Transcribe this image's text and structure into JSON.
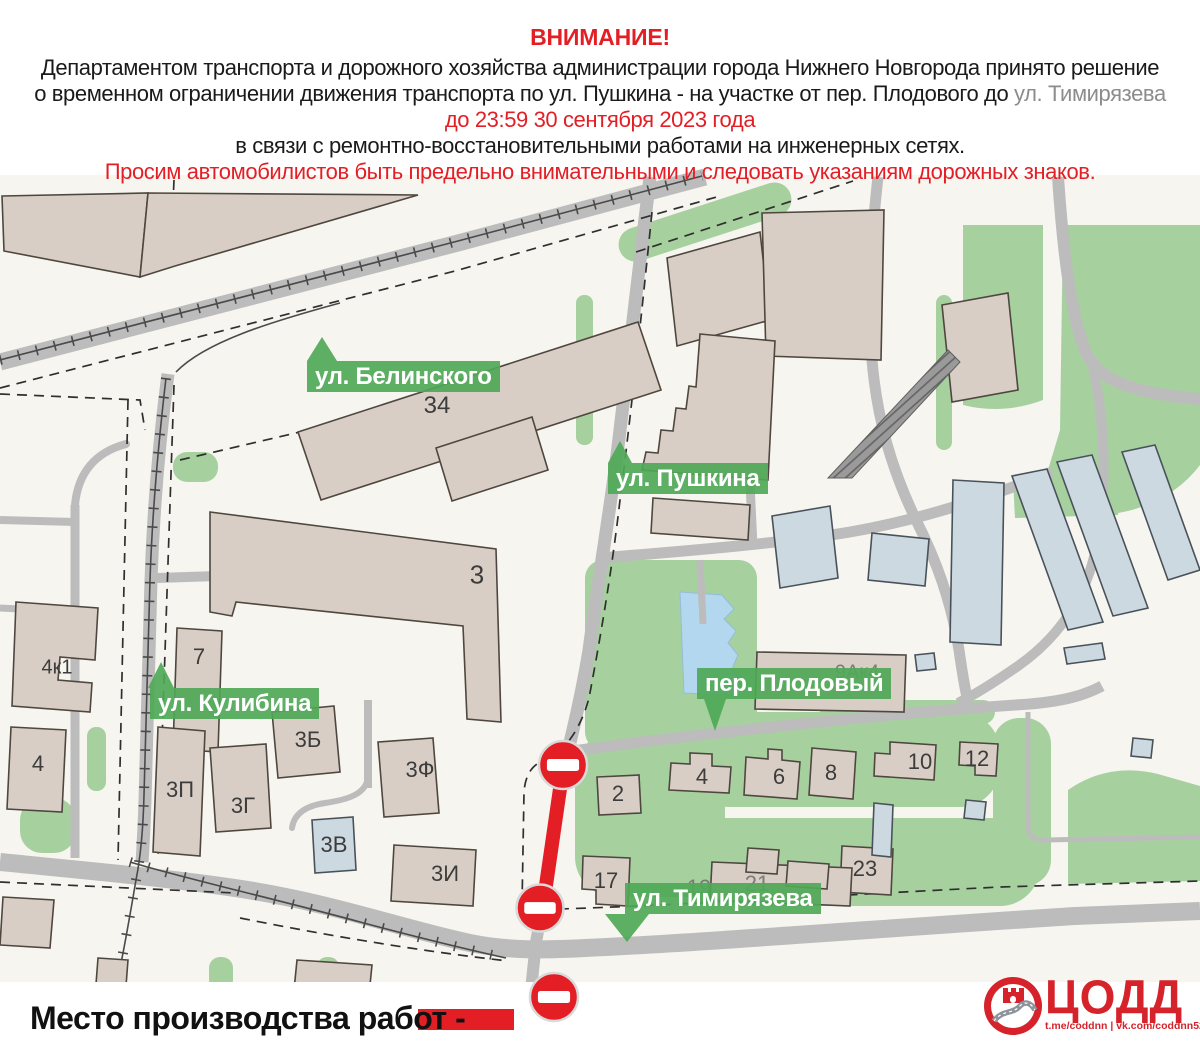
{
  "header": {
    "attention": "ВНИМАНИЕ!",
    "line1": "Департаментом транспорта и дорожного хозяйства администрации города Нижнего Новгорода принято решение",
    "line2_black": "о временном ограничении движения транспорта по ул. Пушкина - на участке от пер. Плодового до ",
    "line2_gray": "ул. Тимирязева",
    "line3": "до 23:59 30 сентября 2023 года",
    "line4": "в связи с ремонтно-восстановительными работами на инженерных сетях.",
    "line5": "Просим автомобилистов быть предельно внимательными и следовать указаниям дорожных знаков."
  },
  "map": {
    "street_labels": [
      {
        "id": "belinskogo",
        "text": "ул. Белинского",
        "x": 307,
        "y": 361,
        "pointer": {
          "dir": "up",
          "dx": 0,
          "w": 30,
          "h": 24
        }
      },
      {
        "id": "pushkina",
        "text": "ул. Пушкина",
        "x": 608,
        "y": 463,
        "pointer": {
          "dir": "up",
          "dx": 0,
          "w": 24,
          "h": 22
        }
      },
      {
        "id": "plodovy",
        "text": "пер. Плодовый",
        "x": 697,
        "y": 668,
        "pointer": {
          "dir": "down",
          "dx": 7,
          "w": 22,
          "h": 32
        }
      },
      {
        "id": "kulibina",
        "text": "ул. Кулибина",
        "x": 150,
        "y": 688,
        "pointer": {
          "dir": "up",
          "dx": -2,
          "w": 26,
          "h": 26
        }
      },
      {
        "id": "timiryazeva",
        "text": "ул. Тимирязева",
        "x": 625,
        "y": 883,
        "pointer": {
          "dir": "down",
          "dx": -20,
          "w": 45,
          "h": 28
        }
      }
    ],
    "building_numbers": [
      {
        "t": "34",
        "x": 437,
        "y": 406,
        "size": 24
      },
      {
        "t": "3",
        "x": 477,
        "y": 575,
        "size": 26
      },
      {
        "t": "7",
        "x": 199,
        "y": 657
      },
      {
        "t": "4к1",
        "x": 57,
        "y": 668,
        "size": 20
      },
      {
        "t": "4",
        "x": 38,
        "y": 764
      },
      {
        "t": "3П",
        "x": 180,
        "y": 790
      },
      {
        "t": "3Б",
        "x": 308,
        "y": 740
      },
      {
        "t": "3Г",
        "x": 243,
        "y": 806
      },
      {
        "t": "3В",
        "x": 334,
        "y": 845
      },
      {
        "t": "3Ф",
        "x": 420,
        "y": 770
      },
      {
        "t": "3И",
        "x": 445,
        "y": 874
      },
      {
        "t": "2",
        "x": 618,
        "y": 794
      },
      {
        "t": "17",
        "x": 606,
        "y": 881
      },
      {
        "t": "4",
        "x": 702,
        "y": 777
      },
      {
        "t": "6",
        "x": 779,
        "y": 777
      },
      {
        "t": "8",
        "x": 831,
        "y": 773
      },
      {
        "t": "10",
        "x": 920,
        "y": 762
      },
      {
        "t": "12",
        "x": 977,
        "y": 759
      },
      {
        "t": "23",
        "x": 865,
        "y": 869
      },
      {
        "t": "19",
        "x": 699,
        "y": 888,
        "faint": true
      },
      {
        "t": "21",
        "x": 757,
        "y": 884,
        "faint": true
      },
      {
        "t": "9Ак4",
        "x": 857,
        "y": 673,
        "faint": true,
        "size": 20
      }
    ],
    "closure": {
      "segment": {
        "x1": 563,
        "y1": 768,
        "x2": 543,
        "y2": 906
      },
      "signs": [
        {
          "x": 563,
          "y": 765,
          "r": 24
        },
        {
          "x": 540,
          "y": 908,
          "r": 23.5
        }
      ],
      "legend_sign": {
        "x": 554,
        "y": 997,
        "r": 24
      }
    }
  },
  "legend": {
    "label": "Место производства работ -"
  },
  "logo": {
    "wordmark": "ЦОДД",
    "social": "t.me/coddnn | vk.com/coddnn52"
  },
  "colors": {
    "accent_red": "#e31e24",
    "logo_red": "#d6222a",
    "label_green": "#4fa857eb",
    "road_gray": "#bcbcbc",
    "building_beige": "#d8cec6",
    "building_blue": "#cdd9e0",
    "green_area": "#a7d09f",
    "pond_blue": "#b4d7f0",
    "map_bg": "#f7f5f0"
  }
}
